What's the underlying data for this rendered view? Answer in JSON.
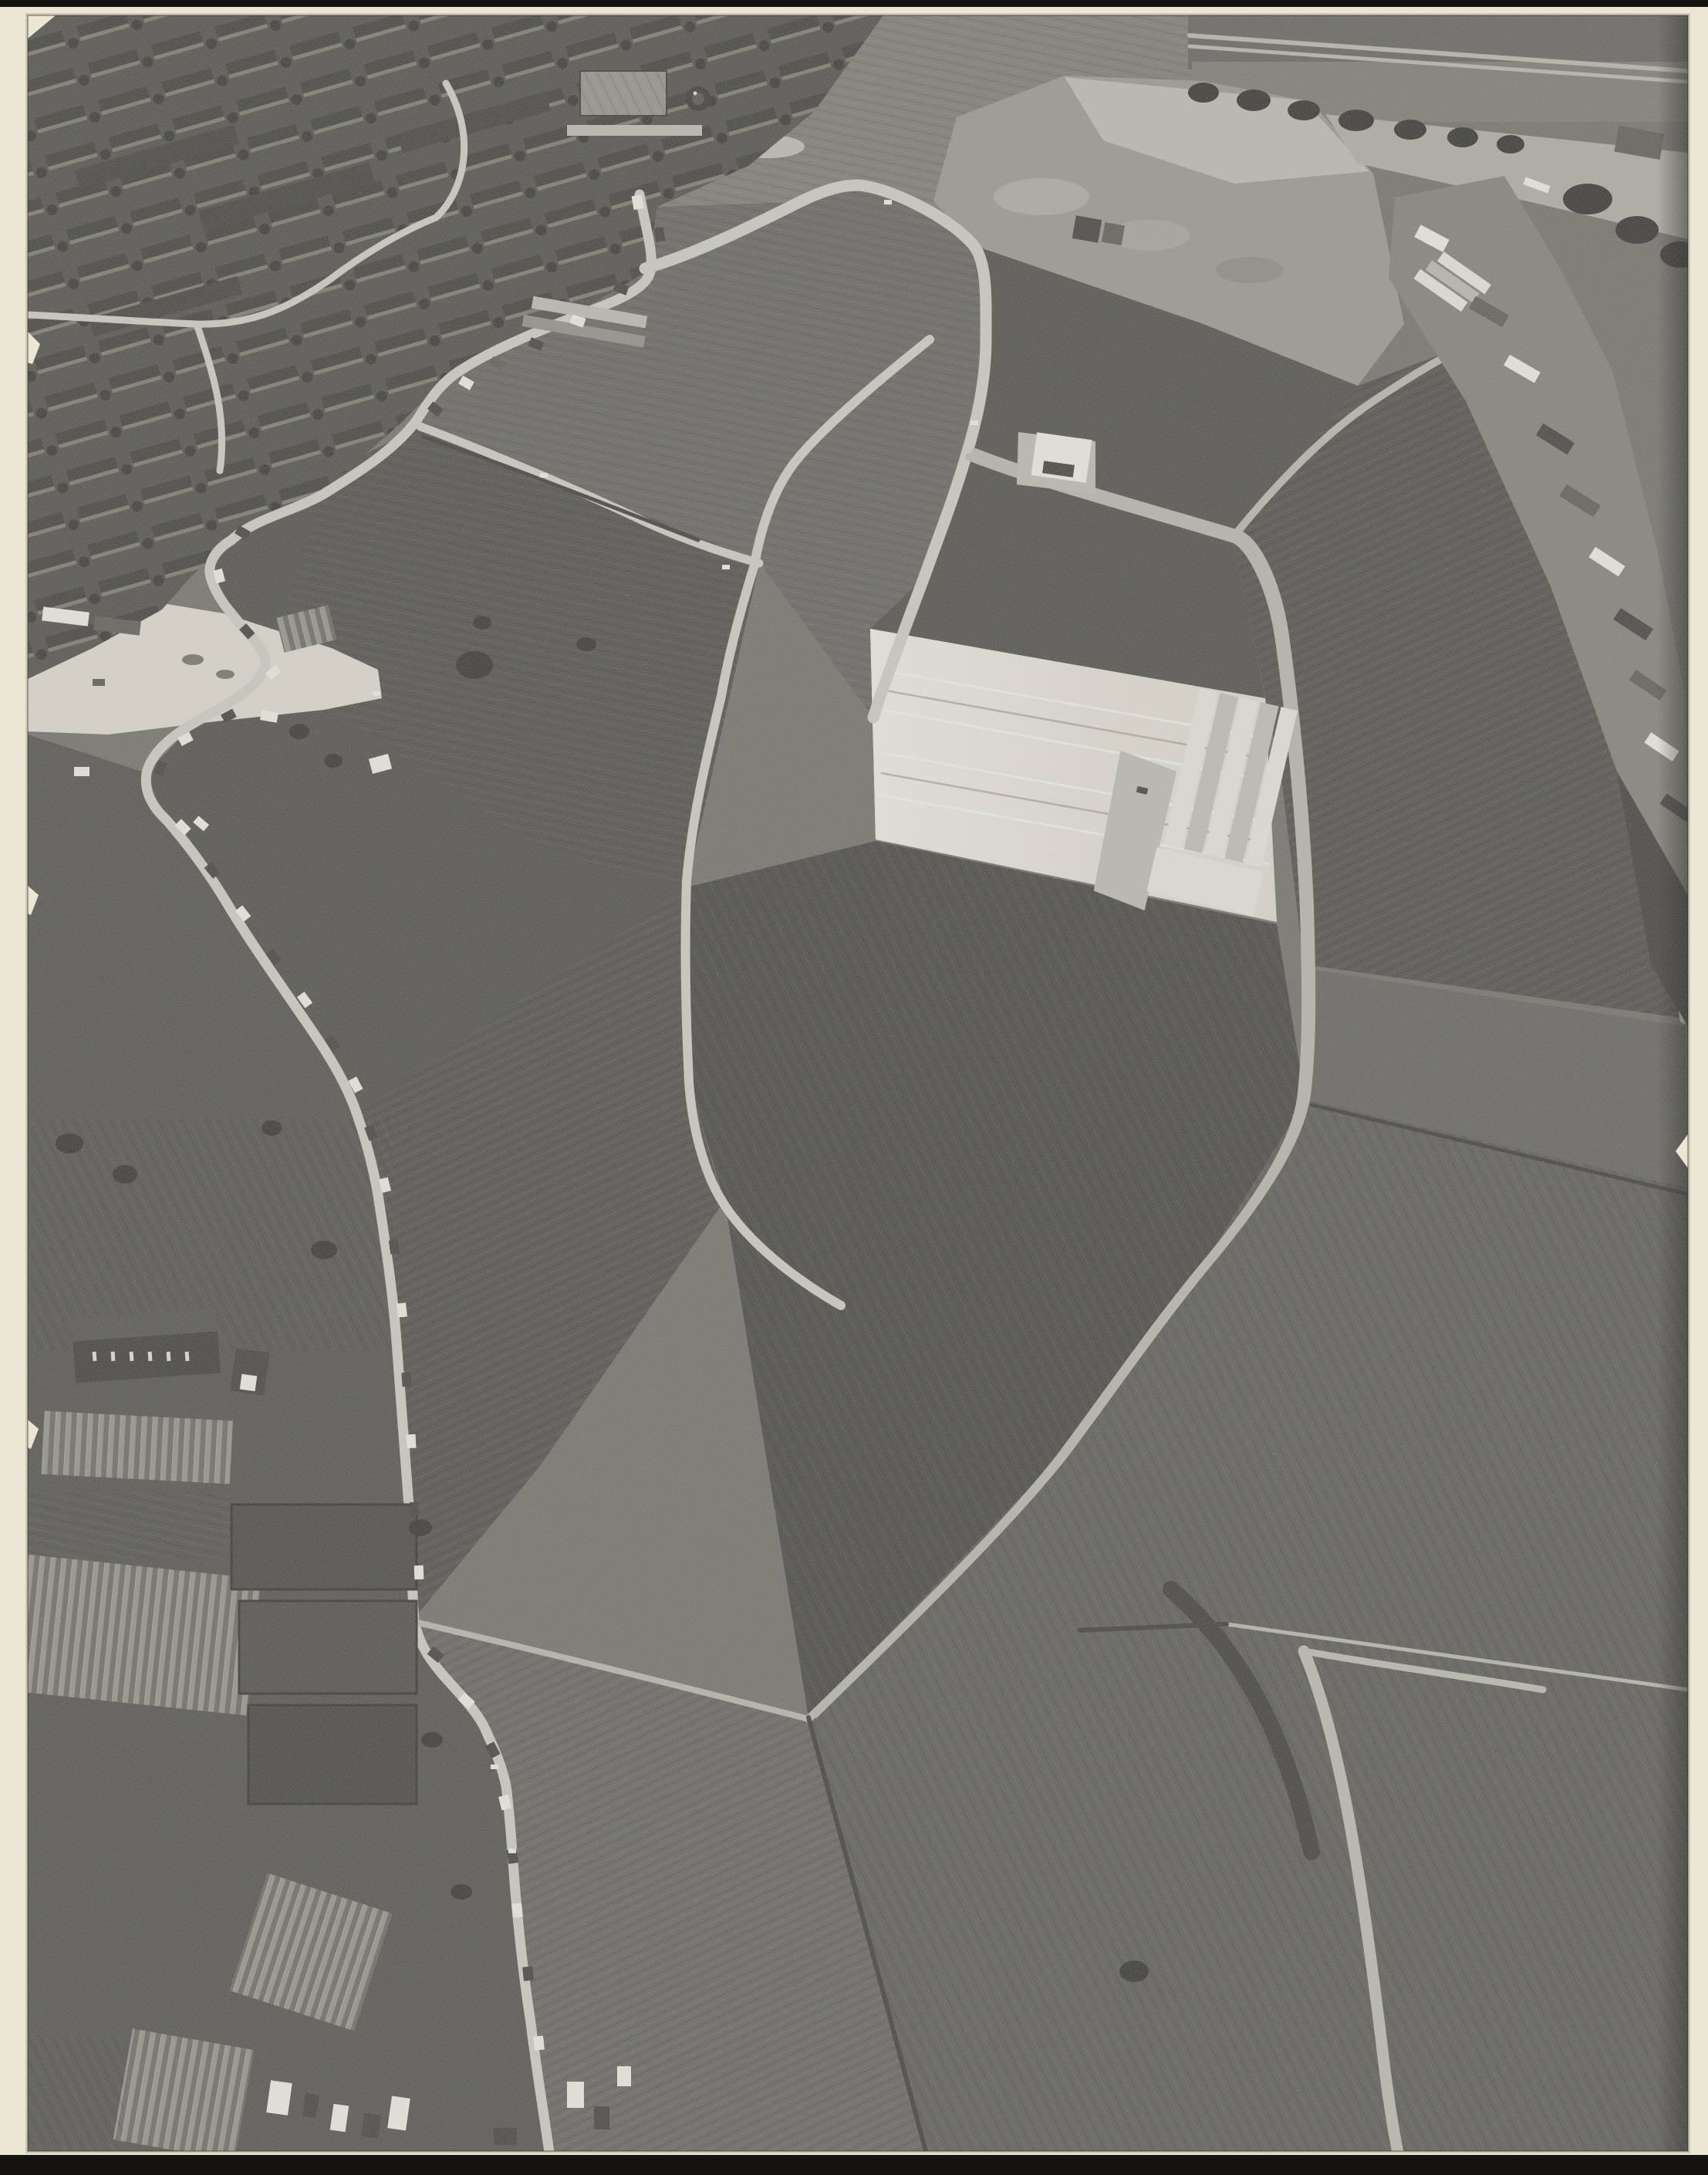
{
  "scene": {
    "title": "Black-and-white oblique aerial photograph mounted on cream card",
    "alt": "Monochrome aerial photograph of a village: a terraced housing estate and water tower at top left, a river with tree rows and a shipyard strip at top right, light curving roads around large dark fields, a bright bare strip with white warehouse sheds at centre right, an S-curving village street lined with houses running to the bottom, greenhouses and a church at bottom left, and dark meadows with a pale winding creek at bottom right. The print sits on a cream mount with a dark backing visible at the top and bottom edges.",
    "regions": [
      {
        "name": "mount-backing",
        "label": "dark backing board visible at top and bottom"
      },
      {
        "name": "mount-card",
        "label": "cream mounting card"
      },
      {
        "name": "photo-print",
        "label": "black-and-white aerial photograph"
      },
      {
        "name": "residential-district",
        "label": "terraced housing estate, top left"
      },
      {
        "name": "water-tower",
        "label": "round water tower"
      },
      {
        "name": "waterworks-building",
        "label": "industrial building beside water tower"
      },
      {
        "name": "highway",
        "label": "tree-lined highway along the top edge"
      },
      {
        "name": "river",
        "label": "river / canal, top right"
      },
      {
        "name": "industrial-waterfront",
        "label": "shipyard and industry strip, right edge"
      },
      {
        "name": "north-field",
        "label": "large dark field inside road loop"
      },
      {
        "name": "ring-road",
        "label": "light curving road around the fields"
      },
      {
        "name": "center-road",
        "label": "straight diagonal road through the fields"
      },
      {
        "name": "dike-track",
        "label": "long dike road with track curving south-west"
      },
      {
        "name": "bare-strip",
        "label": "bright ploughed / cleared strip"
      },
      {
        "name": "warehouse-sheds",
        "label": "white warehouse sheds with gabled bays"
      },
      {
        "name": "sand-patch",
        "label": "pale cleared ground at left"
      },
      {
        "name": "village-street",
        "label": "S-curving village street with ribbon development"
      },
      {
        "name": "street-houses",
        "label": "small houses lining the street"
      },
      {
        "name": "church",
        "label": "church with arched windows, bottom left"
      },
      {
        "name": "greenhouses",
        "label": "glasshouse complexes, bottom left"
      },
      {
        "name": "garden-plots",
        "label": "market-garden plots"
      },
      {
        "name": "meadows",
        "label": "dark meadows, bottom right"
      },
      {
        "name": "creek",
        "label": "pale winding creek in the meadows"
      },
      {
        "name": "torn-edge-chips",
        "label": "small chips on the print edges"
      }
    ]
  },
  "palette": {
    "backing": "#151311",
    "card": "#ece7d5",
    "card_shadow": "#cfc9b6",
    "photo_base": "#6d6c65",
    "grass_light": "#77766e",
    "field_mid": "#605f59",
    "field_dark": "#4b4a44",
    "field_darker": "#42413c",
    "meadow": "#575650",
    "bare_soil": "#d6d3c9",
    "dirt": "#94928a",
    "pale_sand": "#b7b5ac",
    "water": "#a9a79f",
    "tree": "#2f2e2b",
    "hedge": "#393834",
    "road": "#c8c6be",
    "road_dim": "#b2b0a8",
    "wall_white": "#e7e5dd",
    "roof_dark": "#3d3c38",
    "roof_mid": "#585750",
    "warehouse_white": "#dfddd5",
    "industry_base": "#7d7b73",
    "wharf_dark": "#3c3b37",
    "glass_a": "#8f8d85",
    "glass_b": "#66655e"
  }
}
